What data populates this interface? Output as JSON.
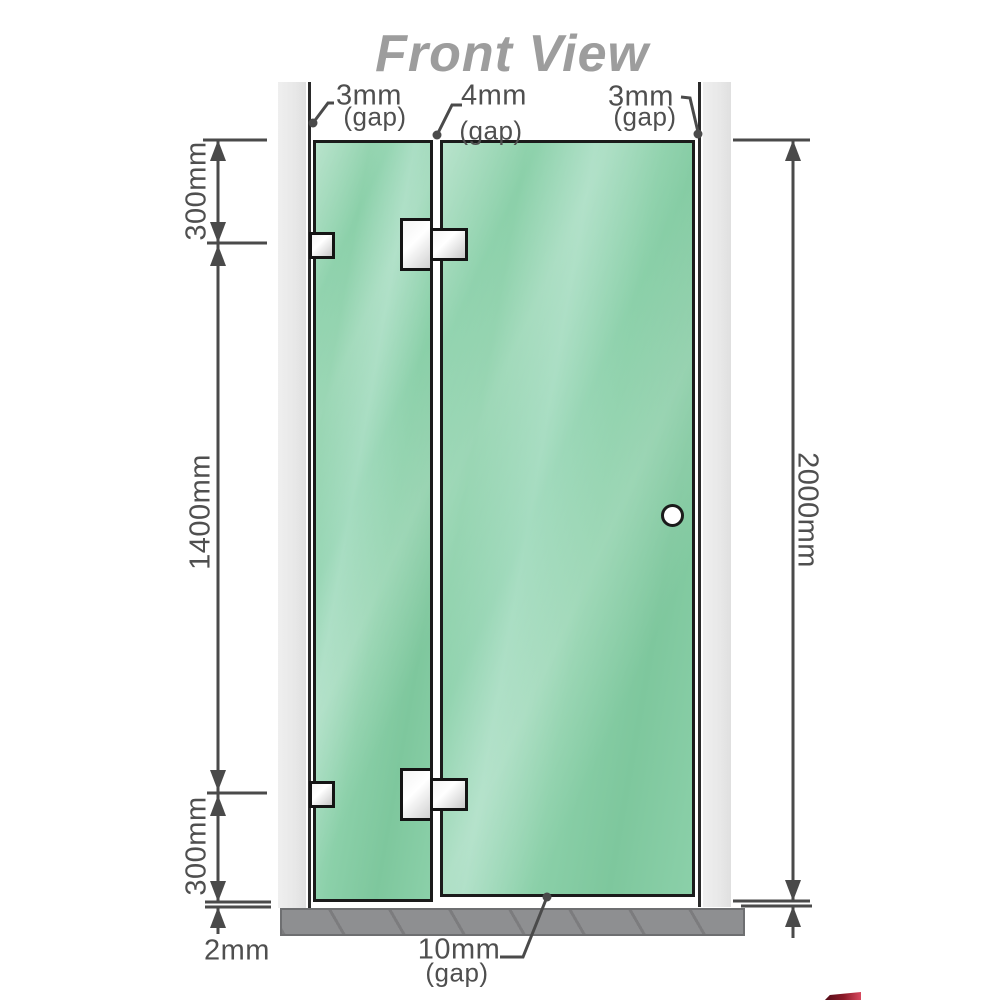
{
  "title": "Front View",
  "gap_labels": {
    "left": {
      "value": "3mm",
      "unit": "(gap)"
    },
    "middle": {
      "value": "4mm",
      "unit": "(gap)"
    },
    "right": {
      "value": "3mm",
      "unit": "(gap)"
    },
    "bottom": {
      "value": "10mm",
      "unit": "(gap)"
    }
  },
  "dimensions": {
    "top_segment": "300mm",
    "middle_segment": "1400mm",
    "bottom_segment": "300mm",
    "floor_clearance": "2mm",
    "total_height": "2000mm"
  },
  "colors": {
    "glass_a": "#9ad7b6",
    "glass_b": "#8bd0a9",
    "glass_c": "#a5dcc0",
    "glass_d": "#7ec79d",
    "wall_gray": "#e8e8e8",
    "floor_gray": "#8e8f91",
    "line_dark": "#4a4a4a",
    "text_gray": "#4f4f4f",
    "title_gray": "#9d9d9d",
    "border_black": "#1b1b1b",
    "hinge_light": "#f4f4f4",
    "hinge_dark": "#c9c9c9",
    "logo_red": "#8c1a28"
  }
}
